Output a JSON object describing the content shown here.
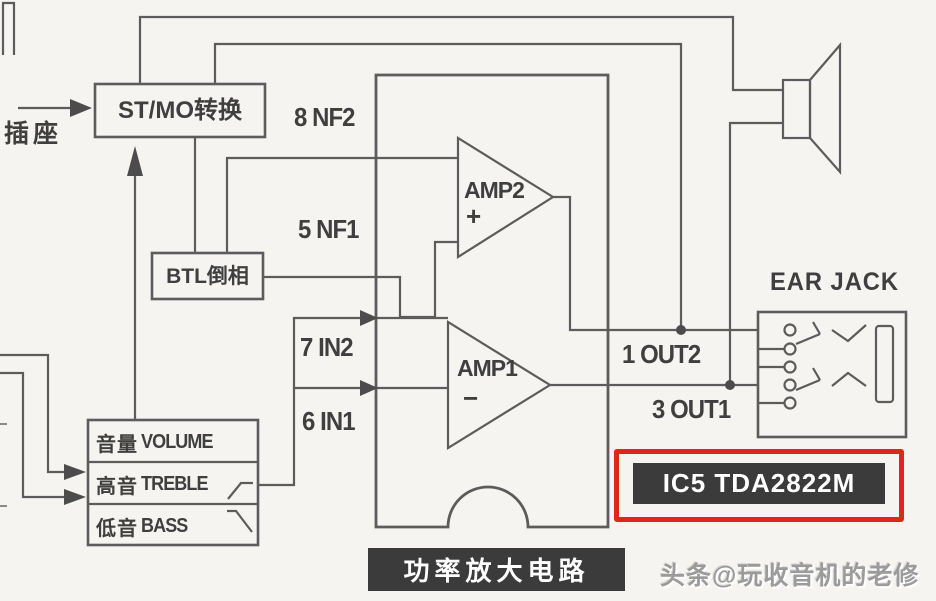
{
  "diagram": {
    "title_note": "audio power amplifier block schematic",
    "socket": "插座",
    "blocks": {
      "stmo": "ST/MO转换",
      "btl": "BTL倒相",
      "ear_jack": "EAR JACK",
      "power_amp": "功率放大电路",
      "ic": "IC5 TDA2822M"
    },
    "pins": {
      "nf2": "8 NF2",
      "nf1": "5 NF1",
      "in2": "7 IN2",
      "in1": "6 IN1",
      "out2": "1 OUT2",
      "out1": "3 OUT1"
    },
    "amps": {
      "amp2": "AMP2",
      "amp2_sign": "+",
      "amp1": "AMP1",
      "amp1_sign": "−"
    },
    "tone": [
      {
        "cn": "音量",
        "en": "VOLUME"
      },
      {
        "cn": "高音",
        "en": "TREBLE"
      },
      {
        "cn": "低音",
        "en": "BASS"
      }
    ],
    "watermark": "头条@玩收音机的老修"
  },
  "colors": {
    "paper": "#f5f4f1",
    "line": "#5c5c5c",
    "text": "#3f3f3f",
    "badge_bg": "#3b3b3b",
    "badge_text": "#ffffff",
    "highlight_red": "#e0251b",
    "watermark_gray": "#9b9b9b"
  }
}
